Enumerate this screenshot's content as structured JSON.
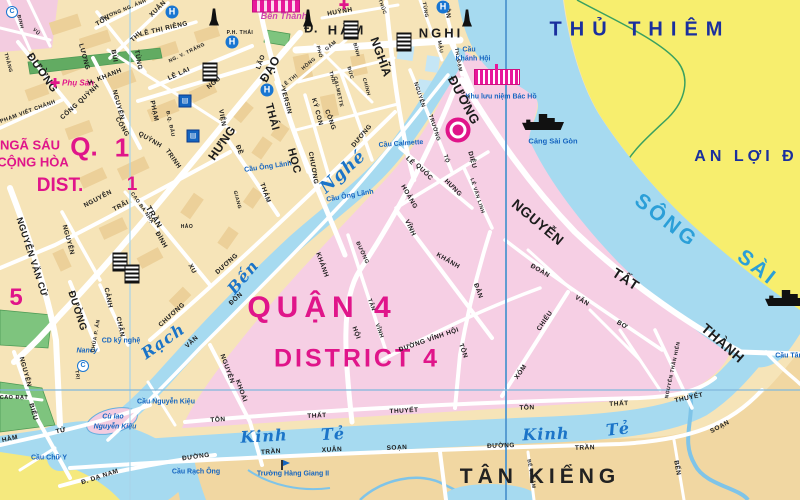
{
  "admin": {
    "thu_thiem": "THỦ THIÊM",
    "an_loi": "AN LỢI Đ",
    "quan_4": "QUẬN 4",
    "district_4": "DISTRICT 4",
    "nga_sau": "NGÃ SÁU",
    "cong_hoa": "CỘNG HÒA",
    "q_label": "Q.",
    "q_num": "1",
    "dist_label": "DIST.",
    "dist_num": "1",
    "district_5_num": "5",
    "tan_kieng": "TÂN KIỂNG"
  },
  "colors": {
    "magenta": "#e0158a",
    "navy": "#1a2f9e",
    "water": "#a6daf0",
    "water_label": "#1b74c8",
    "river_label": "#2b9fd8",
    "poi_blue": "#1565c0",
    "land_d1": "#f6e4b8",
    "land_d4_pink": "#f6cfe4",
    "land_d7": "#f1d7a2",
    "thu_thiem_yellow": "#f7ee6e",
    "d8_yellow": "#f5e97e",
    "park_green": "#7ec47e"
  },
  "labels": [
    {
      "t": "SÔNG",
      "x": 666,
      "y": 221,
      "r": 38,
      "s": 21,
      "c": "riv",
      "n": "song-sai-gon-label"
    },
    {
      "t": "SÀI",
      "x": 757,
      "y": 268,
      "r": 38,
      "s": 21,
      "c": "riv",
      "n": "song-sai-gon-label"
    },
    {
      "t": "Rạch",
      "x": 163,
      "y": 341,
      "r": -35,
      "s": 16,
      "c": "wat",
      "n": "rach-ben-nghe-label"
    },
    {
      "t": "Bến",
      "x": 243,
      "y": 277,
      "r": -50,
      "s": 16,
      "c": "wat",
      "n": "rach-ben-nghe-label"
    },
    {
      "t": "Nghé",
      "x": 343,
      "y": 172,
      "r": -42,
      "s": 17,
      "c": "wat",
      "n": "rach-ben-nghe-label"
    },
    {
      "t": "Kinh",
      "x": 264,
      "y": 436,
      "r": -3,
      "s": 16,
      "c": "wat",
      "n": "kinh-te-label"
    },
    {
      "t": "Tẻ",
      "x": 333,
      "y": 434,
      "r": -3,
      "s": 16,
      "c": "wat",
      "n": "kinh-te-label"
    },
    {
      "t": "Kinh",
      "x": 546,
      "y": 434,
      "r": -2,
      "s": 16,
      "c": "wat",
      "n": "kinh-te-label"
    },
    {
      "t": "Tẻ",
      "x": 618,
      "y": 429,
      "r": -6,
      "s": 16,
      "c": "wat",
      "n": "kinh-te-label"
    },
    {
      "t": "Cầu Ông Lãnh",
      "x": 268,
      "y": 167,
      "r": -8,
      "c": "poi",
      "n": "bridge-label"
    },
    {
      "t": "Cầu Ông Lãnh",
      "x": 350,
      "y": 196,
      "r": -10,
      "c": "poi",
      "n": "bridge-label"
    },
    {
      "t": "Cầu Calmette",
      "x": 401,
      "y": 144,
      "r": -4,
      "c": "poi",
      "n": "bridge-label"
    },
    {
      "t": "Cầu",
      "x": 469,
      "y": 50,
      "c": "poi",
      "n": "bridge-label"
    },
    {
      "t": "Khánh Hội",
      "x": 473,
      "y": 59,
      "c": "poi",
      "n": "bridge-label"
    },
    {
      "t": "Khu lưu niệm Bác Hồ",
      "x": 501,
      "y": 97,
      "c": "poi",
      "n": "memorial-label"
    },
    {
      "t": "Cảng Sài Gòn",
      "x": 553,
      "y": 141,
      "s": 7.5,
      "c": "poi",
      "n": "port-label"
    },
    {
      "t": "Cầu Tân",
      "x": 789,
      "y": 356,
      "c": "poi",
      "n": "bridge-label"
    },
    {
      "t": "Cầu Nguyễn Kiệu",
      "x": 166,
      "y": 402,
      "c": "poi",
      "n": "bridge-label"
    },
    {
      "t": "Cù lao",
      "x": 113,
      "y": 417,
      "c": "poi",
      "i": 1,
      "n": "island-label"
    },
    {
      "t": "Nguyễn Kiệu",
      "x": 115,
      "y": 427,
      "c": "poi",
      "i": 1,
      "n": "island-label"
    },
    {
      "t": "Cầu Chữ Y",
      "x": 49,
      "y": 458,
      "c": "poi",
      "n": "bridge-label"
    },
    {
      "t": "Cầu Rạch Ông",
      "x": 196,
      "y": 472,
      "c": "poi",
      "n": "bridge-label"
    },
    {
      "t": "Trường Hàng Giang II",
      "x": 293,
      "y": 474,
      "c": "poi",
      "n": "school-label"
    },
    {
      "t": "Nancy",
      "x": 87,
      "y": 351,
      "c": "poi",
      "i": 1,
      "n": "church-label"
    },
    {
      "t": "CD kỹ nghệ",
      "x": 121,
      "y": 341,
      "c": "poi",
      "n": "college-label"
    },
    {
      "t": "Bến Thành",
      "x": 284,
      "y": 16,
      "s": 9,
      "c": "mkt",
      "i": 1,
      "n": "ben-thanh-market-label"
    },
    {
      "t": "Phụ Sản",
      "x": 78,
      "y": 83,
      "s": 8,
      "c": "hos",
      "i": 1,
      "n": "hospital-label"
    },
    {
      "t": "ĐƯỜNG",
      "x": 42,
      "y": 73,
      "r": 55,
      "s": 11
    },
    {
      "t": "PHẠM VIẾT CHÁNH",
      "x": 28,
      "y": 112,
      "r": -20,
      "s": 5.5
    },
    {
      "t": "CỐNG QUỲNH",
      "x": 80,
      "y": 102,
      "r": -42
    },
    {
      "t": "LƯƠNG",
      "x": 84,
      "y": 57,
      "r": 75
    },
    {
      "t": "BÙI",
      "x": 114,
      "y": 56,
      "r": 80
    },
    {
      "t": "VIỆN",
      "x": 222,
      "y": 118,
      "r": 80
    },
    {
      "t": "THỊ",
      "x": 136,
      "y": 37,
      "r": -45
    },
    {
      "t": "XUÂN",
      "x": 158,
      "y": 9,
      "r": -45
    },
    {
      "t": "TÔN",
      "x": 103,
      "y": 21,
      "r": -30
    },
    {
      "t": "TÙNG",
      "x": 138,
      "y": 60,
      "r": 80
    },
    {
      "t": "SƯƠNG NG. ÁNH",
      "x": 124,
      "y": 10,
      "r": -22,
      "s": 5
    },
    {
      "t": "LÊ THỊ RIÊNG",
      "x": 164,
      "y": 29,
      "r": -13
    },
    {
      "t": "H. KHANH",
      "x": 105,
      "y": 77,
      "r": -22
    },
    {
      "t": "NG. V. TRÁNG",
      "x": 187,
      "y": 53,
      "r": -26,
      "s": 5
    },
    {
      "t": "LÊ LAI",
      "x": 179,
      "y": 74,
      "r": -24
    },
    {
      "t": "NGŨ",
      "x": 214,
      "y": 83,
      "r": -40
    },
    {
      "t": "LÃO",
      "x": 261,
      "y": 62,
      "r": -70
    },
    {
      "t": "PHẠM",
      "x": 154,
      "y": 111,
      "r": 78
    },
    {
      "t": "Đ.Q. ĐẨU",
      "x": 170,
      "y": 124,
      "r": 78,
      "s": 5
    },
    {
      "t": "NGUYỄN",
      "x": 118,
      "y": 105,
      "r": 75
    },
    {
      "t": "CỐNG",
      "x": 122,
      "y": 127,
      "r": 60
    },
    {
      "t": "QUỲNH",
      "x": 150,
      "y": 140,
      "r": 30
    },
    {
      "t": "TRINH",
      "x": 173,
      "y": 159,
      "r": 55
    },
    {
      "t": "HƯNG",
      "x": 222,
      "y": 143,
      "r": -55,
      "s": 12
    },
    {
      "t": "ĐẠO",
      "x": 270,
      "y": 69,
      "r": -60,
      "s": 12
    },
    {
      "t": "NGUYỄN",
      "x": 98,
      "y": 199,
      "r": -28
    },
    {
      "t": "TRÃI",
      "x": 121,
      "y": 206,
      "r": -28
    },
    {
      "t": "CAO BÁ NHẠ",
      "x": 142,
      "y": 208,
      "r": 55,
      "s": 5
    },
    {
      "t": "TRẦN",
      "x": 154,
      "y": 217,
      "r": 60,
      "s": 8
    },
    {
      "t": "ĐÌNH",
      "x": 161,
      "y": 240,
      "r": 60
    },
    {
      "t": "XU",
      "x": 192,
      "y": 269,
      "r": 60
    },
    {
      "t": "HẢO",
      "x": 187,
      "y": 227,
      "s": 5
    },
    {
      "t": "NGUYỄN VĂN CỪ",
      "x": 32,
      "y": 257,
      "r": 72,
      "s": 9
    },
    {
      "t": "NGUYỄN",
      "x": 68,
      "y": 240,
      "r": 75
    },
    {
      "t": "ĐƯỜNG",
      "x": 77,
      "y": 311,
      "r": 72,
      "s": 10
    },
    {
      "t": "CẢNH",
      "x": 108,
      "y": 298,
      "r": 78
    },
    {
      "t": "CHÂN",
      "x": 120,
      "y": 327,
      "r": 78
    },
    {
      "t": "CHÙA P. ẤN",
      "x": 96,
      "y": 336,
      "r": -80,
      "s": 5
    },
    {
      "t": "TRỊ",
      "x": 77,
      "y": 375,
      "r": 80,
      "s": 5
    },
    {
      "t": "NGUYỄN",
      "x": 25,
      "y": 372,
      "r": 75
    },
    {
      "t": "BIỂU",
      "x": 33,
      "y": 412,
      "r": 75
    },
    {
      "t": "CAO ĐẠT",
      "x": 14,
      "y": 398,
      "s": 5.5
    },
    {
      "t": "HÀM",
      "x": 10,
      "y": 439,
      "r": -12
    },
    {
      "t": "TỬ",
      "x": 61,
      "y": 431,
      "r": -12
    },
    {
      "t": "CHƯƠNG",
      "x": 172,
      "y": 315,
      "r": -42
    },
    {
      "t": "DƯƠNG",
      "x": 227,
      "y": 264,
      "r": -42
    },
    {
      "t": "CHƯƠNG",
      "x": 313,
      "y": 168,
      "r": 80
    },
    {
      "t": "DƯƠNG",
      "x": 362,
      "y": 136,
      "r": -50
    },
    {
      "t": "ĐỀ",
      "x": 239,
      "y": 150,
      "r": 70
    },
    {
      "t": "THÁM",
      "x": 265,
      "y": 193,
      "r": 70
    },
    {
      "t": "GIANG",
      "x": 237,
      "y": 200,
      "r": 75,
      "s": 5
    },
    {
      "t": "YERSIN",
      "x": 286,
      "y": 101,
      "r": 75
    },
    {
      "t": "KÝ CON",
      "x": 317,
      "y": 112,
      "r": 75
    },
    {
      "t": "CÔNG",
      "x": 330,
      "y": 120,
      "r": 70
    },
    {
      "t": "LÊ THỊ",
      "x": 290,
      "y": 81,
      "r": -40,
      "s": 5
    },
    {
      "t": "HỒNG",
      "x": 309,
      "y": 64,
      "r": -40,
      "s": 5
    },
    {
      "t": "GẤM",
      "x": 331,
      "y": 46,
      "r": -40,
      "s": 5
    },
    {
      "t": "THÁI",
      "x": 332,
      "y": 78,
      "r": 75,
      "s": 5
    },
    {
      "t": "BÌNH",
      "x": 356,
      "y": 50,
      "r": 75,
      "s": 5
    },
    {
      "t": "PHÓ",
      "x": 319,
      "y": 52,
      "r": 75,
      "s": 5
    },
    {
      "t": "ĐỨC",
      "x": 350,
      "y": 73,
      "r": 75,
      "s": 5
    },
    {
      "t": "CHÍNH",
      "x": 366,
      "y": 87,
      "r": 75,
      "s": 5
    },
    {
      "t": "CALMETTE",
      "x": 338,
      "y": 92,
      "r": 78,
      "s": 5
    },
    {
      "t": "THÁI",
      "x": 272,
      "y": 117,
      "r": 75,
      "s": 11
    },
    {
      "t": "HỌC",
      "x": 294,
      "y": 161,
      "r": 75,
      "s": 11
    },
    {
      "t": "Đ.",
      "x": 311,
      "y": 28,
      "s": 13
    },
    {
      "t": "HÀM",
      "x": 347,
      "y": 30,
      "s": 13,
      "ls": 3
    },
    {
      "t": "NGHI",
      "x": 441,
      "y": 33,
      "s": 13,
      "ls": 3
    },
    {
      "t": "NGHĨA",
      "x": 381,
      "y": 57,
      "r": 70,
      "s": 12
    },
    {
      "t": "HUỲNH",
      "x": 340,
      "y": 12,
      "r": -10
    },
    {
      "t": "THÚC",
      "x": 382,
      "y": 7,
      "r": 70,
      "s": 5
    },
    {
      "t": "TÔN",
      "x": 447,
      "y": 11,
      "r": 80
    },
    {
      "t": "TH. ĐẠM",
      "x": 458,
      "y": 60,
      "r": 80,
      "s": 5
    },
    {
      "t": "TÙNG",
      "x": 425,
      "y": 10,
      "r": 80,
      "s": 5
    },
    {
      "t": "MẬU",
      "x": 440,
      "y": 47,
      "r": 80,
      "s": 5
    },
    {
      "t": "ĐINH",
      "x": 20,
      "y": 22,
      "r": 75,
      "s": 5
    },
    {
      "t": "VŨ",
      "x": 36,
      "y": 32,
      "r": 45,
      "s": 5
    },
    {
      "t": "THẲNG",
      "x": 8,
      "y": 63,
      "r": 75,
      "s": 5
    },
    {
      "t": "P.H. THÁI",
      "x": 240,
      "y": 33,
      "s": 5
    },
    {
      "t": "ĐƯỜNG",
      "x": 464,
      "y": 100,
      "r": 62,
      "s": 13,
      "n": "nguyen-tat-thanh-label"
    },
    {
      "t": "NGUYỄN",
      "x": 538,
      "y": 222,
      "r": 40,
      "s": 14,
      "n": "nguyen-tat-thanh-label"
    },
    {
      "t": "TẤT",
      "x": 626,
      "y": 279,
      "r": 33,
      "s": 14,
      "n": "nguyen-tat-thanh-label"
    },
    {
      "t": "THÀNH",
      "x": 723,
      "y": 343,
      "r": 41,
      "s": 14,
      "n": "nguyen-tat-thanh-label"
    },
    {
      "t": "NGUYỄN",
      "x": 419,
      "y": 95,
      "r": 72,
      "s": 5.5
    },
    {
      "t": "TRƯỜNG",
      "x": 434,
      "y": 128,
      "r": 72,
      "s": 5.5
    },
    {
      "t": "TỘ",
      "x": 446,
      "y": 159,
      "r": 72,
      "s": 5.5
    },
    {
      "t": "LÊ",
      "x": 410,
      "y": 161,
      "r": 45
    },
    {
      "t": "QUỐC",
      "x": 424,
      "y": 172,
      "r": 45
    },
    {
      "t": "HƯNG",
      "x": 453,
      "y": 188,
      "r": 45
    },
    {
      "t": "HOÀNG",
      "x": 409,
      "y": 197,
      "r": 60
    },
    {
      "t": "DIỆU",
      "x": 472,
      "y": 160,
      "r": 75
    },
    {
      "t": "LÊ VĂN LINH",
      "x": 477,
      "y": 196,
      "r": 72,
      "s": 5
    },
    {
      "t": "VĨNH",
      "x": 410,
      "y": 228,
      "r": 65
    },
    {
      "t": "KHÁNH",
      "x": 448,
      "y": 261,
      "r": 30
    },
    {
      "t": "VÂN",
      "x": 192,
      "y": 342,
      "r": -42
    },
    {
      "t": "ĐỒN",
      "x": 236,
      "y": 299,
      "r": -42
    },
    {
      "t": "KHÁNH",
      "x": 322,
      "y": 265,
      "r": 70
    },
    {
      "t": "HỘI",
      "x": 356,
      "y": 333,
      "r": 70
    },
    {
      "t": "ĐƯỜNG",
      "x": 362,
      "y": 253,
      "r": 65,
      "s": 5.5
    },
    {
      "t": "TÂN",
      "x": 371,
      "y": 305,
      "r": 70,
      "s": 5.5
    },
    {
      "t": "VĨNH",
      "x": 379,
      "y": 331,
      "r": 70,
      "s": 5.5
    },
    {
      "t": "ĐƯỜNG VĨNH HỘI",
      "x": 429,
      "y": 340,
      "r": -19
    },
    {
      "t": "TÔN",
      "x": 463,
      "y": 351,
      "r": 70
    },
    {
      "t": "ĐẢN",
      "x": 478,
      "y": 291,
      "r": 70
    },
    {
      "t": "XÓM",
      "x": 521,
      "y": 372,
      "r": -55
    },
    {
      "t": "CHIẾU",
      "x": 545,
      "y": 321,
      "r": -55
    },
    {
      "t": "ĐOÀN",
      "x": 540,
      "y": 271,
      "r": 30
    },
    {
      "t": "VĂN",
      "x": 582,
      "y": 301,
      "r": 30
    },
    {
      "t": "BƠ",
      "x": 622,
      "y": 325,
      "r": 30
    },
    {
      "t": "NGUYỄN THẦN HIẾN",
      "x": 673,
      "y": 370,
      "r": -78,
      "s": 5
    },
    {
      "t": "NGUYỄN",
      "x": 227,
      "y": 369,
      "r": 70
    },
    {
      "t": "KHOÁI",
      "x": 241,
      "y": 391,
      "r": 70
    },
    {
      "t": "TÔN",
      "x": 218,
      "y": 420,
      "r": -4
    },
    {
      "t": "THẤT",
      "x": 317,
      "y": 416,
      "r": -3
    },
    {
      "t": "THUYẾT",
      "x": 404,
      "y": 411,
      "r": -3
    },
    {
      "t": "TÔN",
      "x": 527,
      "y": 408,
      "r": -2
    },
    {
      "t": "THẤT",
      "x": 619,
      "y": 404,
      "r": -3
    },
    {
      "t": "THUYẾT",
      "x": 689,
      "y": 398,
      "r": -12
    },
    {
      "t": "BẾN",
      "x": 677,
      "y": 468,
      "r": 80
    },
    {
      "t": "ĐƯỜNG",
      "x": 196,
      "y": 457,
      "r": -8
    },
    {
      "t": "TRẦN",
      "x": 271,
      "y": 452,
      "r": -4
    },
    {
      "t": "XUÂN",
      "x": 332,
      "y": 450,
      "r": -3
    },
    {
      "t": "SOẠN",
      "x": 397,
      "y": 448,
      "r": -3
    },
    {
      "t": "ĐƯỜNG",
      "x": 501,
      "y": 446,
      "r": -2
    },
    {
      "t": "TRẦN",
      "x": 585,
      "y": 448,
      "r": -2
    },
    {
      "t": "SOẠN",
      "x": 720,
      "y": 427,
      "r": -28
    },
    {
      "t": "Đ. DẠ NAM",
      "x": 100,
      "y": 477,
      "r": -18
    },
    {
      "t": "BẾ V. CẤM",
      "x": 531,
      "y": 474,
      "r": 80,
      "s": 5
    }
  ],
  "icons": [
    {
      "k": "hospital",
      "x": 172,
      "y": 12
    },
    {
      "k": "hospital",
      "x": 232,
      "y": 42
    },
    {
      "k": "hospital",
      "x": 267,
      "y": 90
    },
    {
      "k": "hospital",
      "x": 443,
      "y": 7
    },
    {
      "k": "cross",
      "x": 55,
      "y": 83
    },
    {
      "k": "cross",
      "x": 344,
      "y": 5
    },
    {
      "k": "monument",
      "x": 214,
      "y": 17
    },
    {
      "k": "monument",
      "x": 308,
      "y": 18
    },
    {
      "k": "monument",
      "x": 467,
      "y": 18
    },
    {
      "k": "building",
      "x": 351,
      "y": 30
    },
    {
      "k": "building",
      "x": 404,
      "y": 42
    },
    {
      "k": "building",
      "x": 120,
      "y": 262
    },
    {
      "k": "building",
      "x": 132,
      "y": 274
    },
    {
      "k": "building",
      "x": 210,
      "y": 72
    },
    {
      "k": "school",
      "x": 185,
      "y": 101
    },
    {
      "k": "school",
      "x": 193,
      "y": 136
    },
    {
      "k": "cdiamond",
      "x": 12,
      "y": 12
    },
    {
      "k": "cdiamond",
      "x": 83,
      "y": 366
    },
    {
      "k": "ship",
      "x": 543,
      "y": 122
    },
    {
      "k": "ship",
      "x": 786,
      "y": 298
    },
    {
      "k": "market",
      "x": 276,
      "y": 6
    },
    {
      "k": "memorial",
      "x": 497,
      "y": 77
    },
    {
      "k": "ring",
      "x": 458,
      "y": 130
    },
    {
      "k": "flag",
      "x": 282,
      "y": 465
    }
  ]
}
